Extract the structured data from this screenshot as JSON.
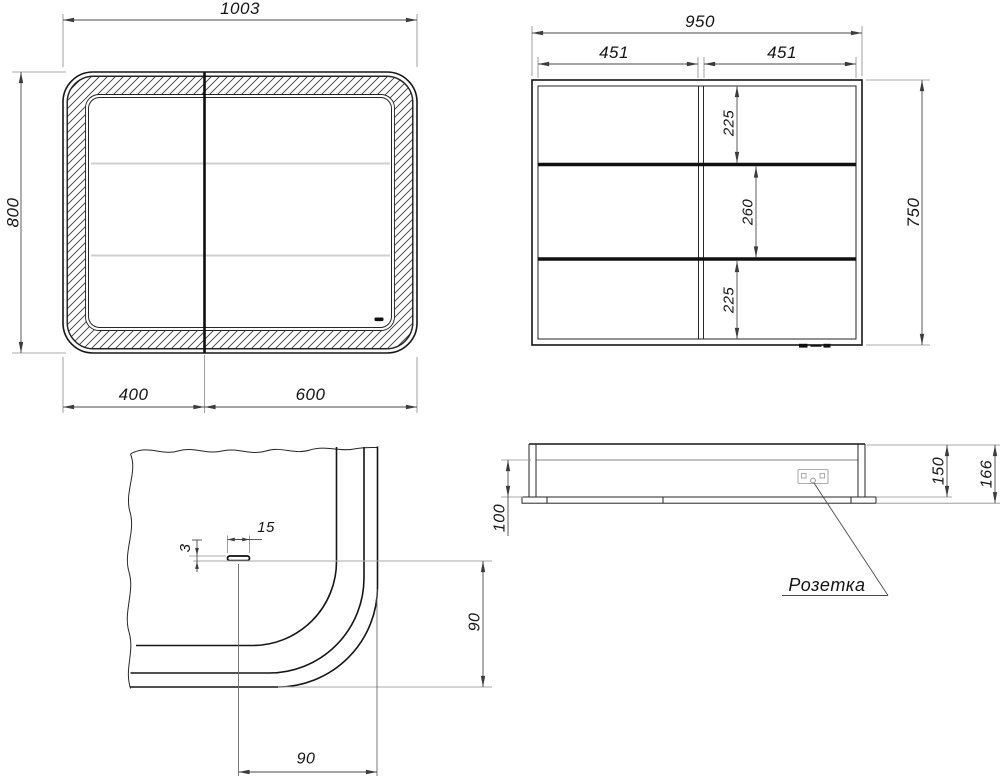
{
  "front_view": {
    "overall_width": "1003",
    "overall_height": "800",
    "left_door_width": "400",
    "right_door_width": "600"
  },
  "carcass_view": {
    "overall_width": "950",
    "left_section_width": "451",
    "right_section_width": "451",
    "overall_height": "750",
    "top_section_height": "225",
    "middle_section_height": "260",
    "bottom_section_height": "225"
  },
  "corner_detail": {
    "sensor_width": "15",
    "sensor_height": "3",
    "sensor_offset_vertical": "90",
    "sensor_offset_horizontal": "90"
  },
  "bottom_view": {
    "inner_depth": "100",
    "carcass_depth": "150",
    "overall_depth": "166",
    "socket_label": "Розетка"
  }
}
